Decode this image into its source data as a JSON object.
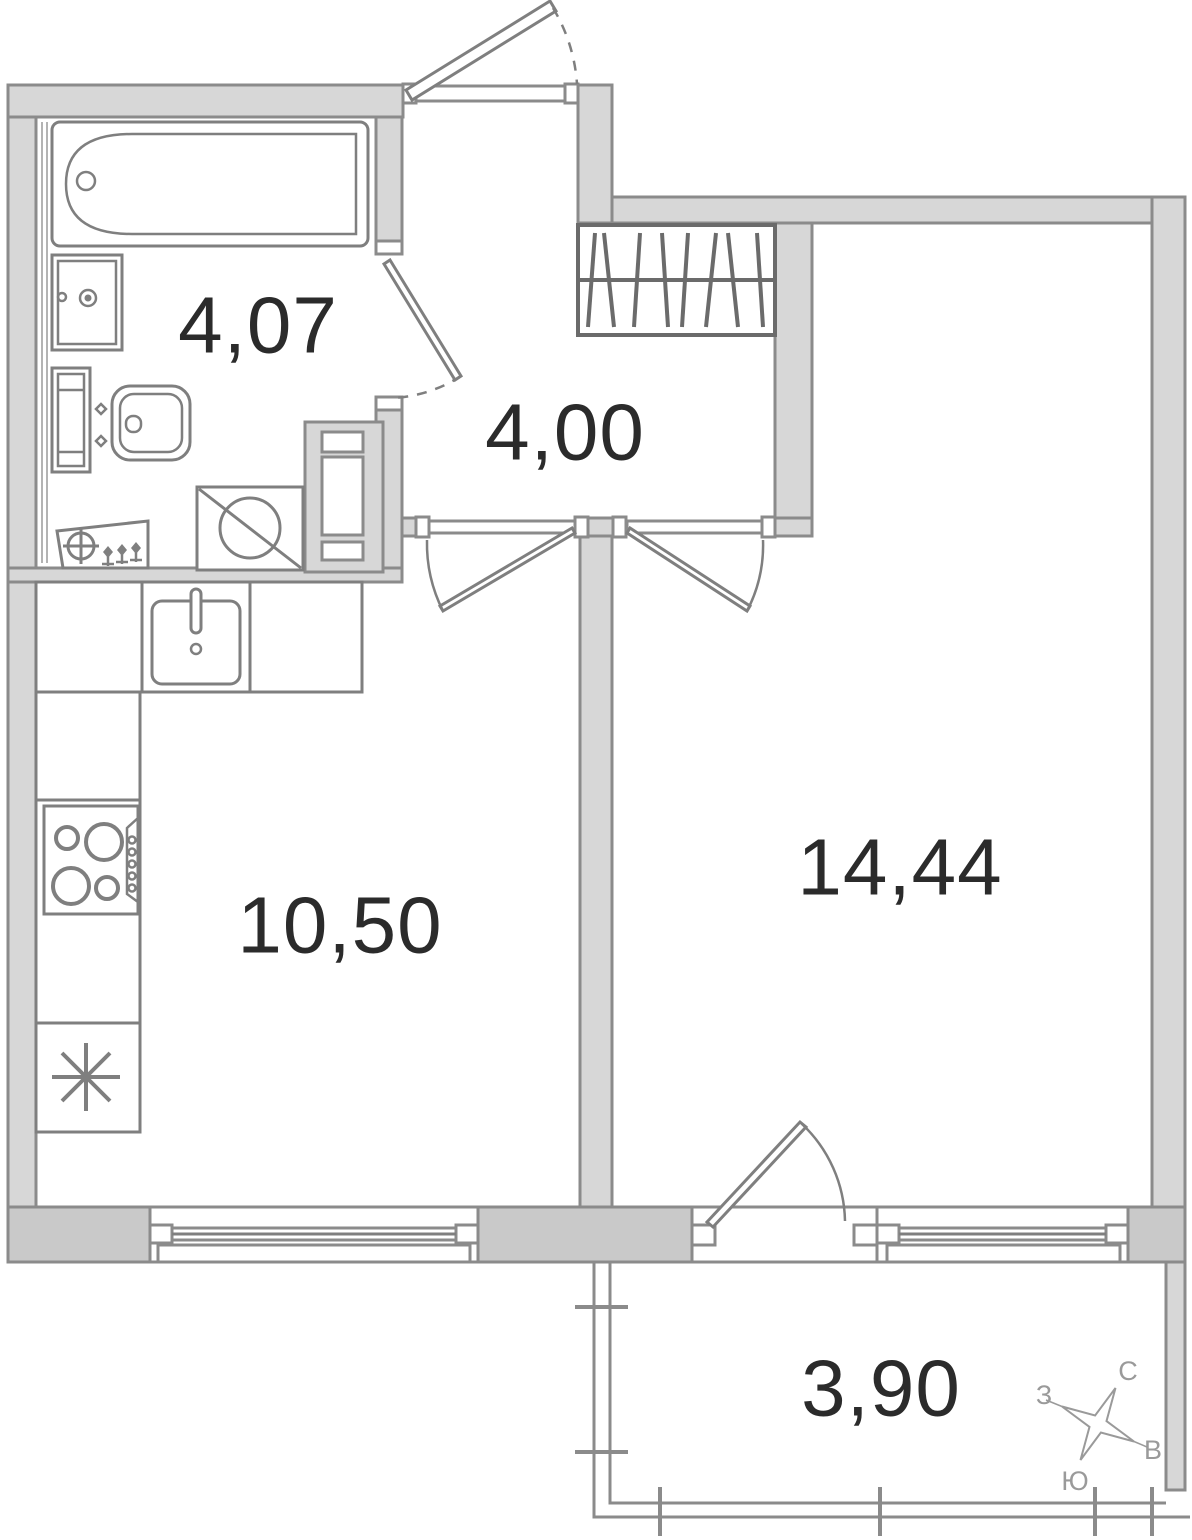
{
  "title": "apartment-floor-plan",
  "rooms": {
    "bathroom": {
      "area": "4,07"
    },
    "hallway": {
      "area": "4,00"
    },
    "kitchen": {
      "area": "10,50"
    },
    "living_room": {
      "area": "14,44"
    },
    "balcony": {
      "area": "3,90"
    }
  },
  "compass": {
    "north": "С",
    "west": "З",
    "east": "В",
    "south": "Ю"
  },
  "fixtures": {
    "bathroom": [
      "bathtub",
      "sink",
      "toilet",
      "heated-towel-rail",
      "washing-machine",
      "duct-shaft"
    ],
    "kitchen": [
      "counter-run",
      "kitchen-sink",
      "stove",
      "refrigerator"
    ],
    "hallway": [
      "wardrobe"
    ]
  },
  "colors": {
    "background": "#ffffff",
    "wall-fill": "#d7d7d7",
    "wall-fill-dark": "#c9c9c9",
    "wall-stroke": "#8b8b8b",
    "fixture-stroke": "#7f7f7f",
    "furniture-stroke": "#6b6b6b",
    "label-text": "#2b2b2b",
    "compass-text": "#9a9a9a"
  }
}
